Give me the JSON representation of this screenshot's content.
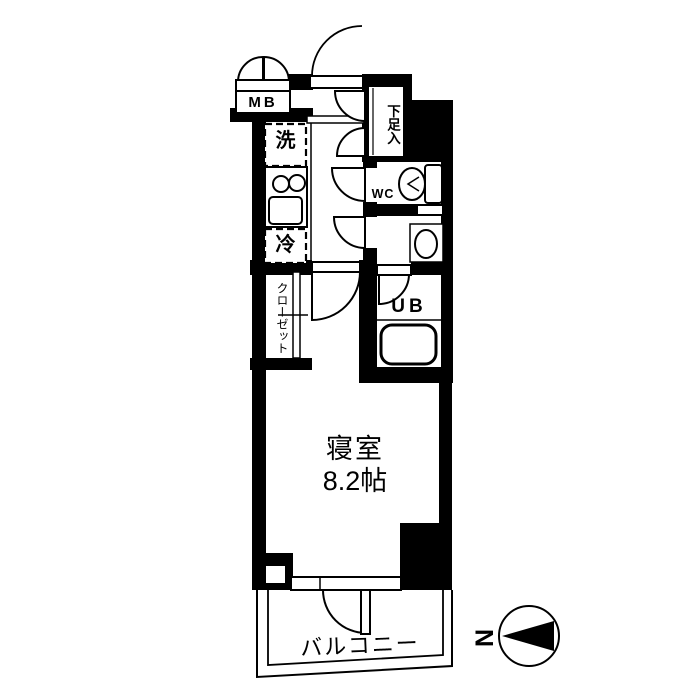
{
  "floorplan": {
    "labels": {
      "meter_box": "MB",
      "washing_machine": "洗",
      "refrigerator": "冷",
      "shoe_storage": "下足入",
      "wc": "WC",
      "unit_bath": "UB",
      "closet": "クローゼット",
      "bedroom": "寝室",
      "bedroom_size": "8.2帖",
      "balcony": "バルコニー",
      "compass_north": "N"
    },
    "colors": {
      "wall": "#000000",
      "floor": "#ffffff"
    }
  }
}
